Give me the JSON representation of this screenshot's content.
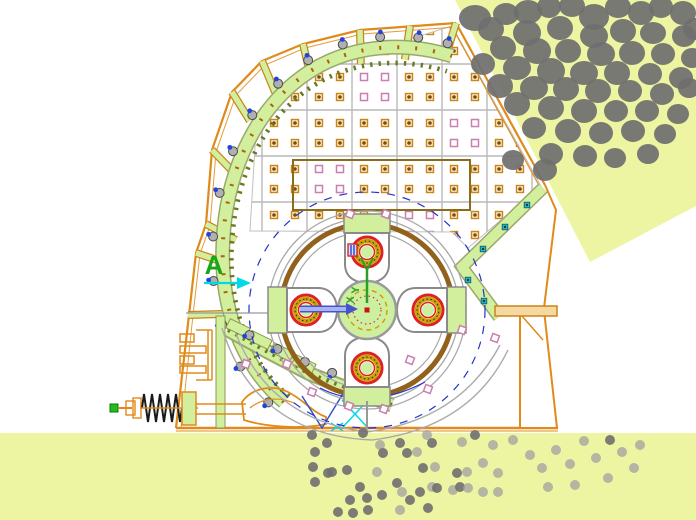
{
  "drawing": {
    "type": "cad-section-view-impact-crusher",
    "labels": {
      "section_a": "A",
      "axis_y": "Y",
      "axis_x": "X"
    }
  },
  "colors": {
    "ground": "#eef5a2",
    "rock": "#6f6f6f",
    "rock_light": "#a0a0a0",
    "casing_orange": "#e08a1a",
    "liner_fill": "#d2ef9e",
    "liner_edge": "#9aa86a",
    "teeth_olive": "#6b7a1e",
    "panel_line": "#b9b9b9",
    "bolt_pink": "#cc7fae",
    "bolt_orange": "#cc8418",
    "bolt_dot": "#7a4a10",
    "rotor_brown": "#92621c",
    "circle_gray": "#a8a8a8",
    "dashed_blue": "#2233cc",
    "ring_red": "#dd2222",
    "ring_gold": "#c8a300",
    "hub_fill": "#cdf0a0",
    "hub_dash": "#e09a00",
    "ucs_green": "#2aa02a",
    "label_green": "#17a617",
    "arrow_blue": "#4455cc",
    "arrow_blue_light": "#aab2f2",
    "cyan": "#00d9e8",
    "chute_bolt": "#2bb8c8",
    "spring_black": "#1a1a1a",
    "tip_green": "#22bb22",
    "olive_frame": "#8a6d1b"
  },
  "hub": {
    "x": 367,
    "y": 310
  },
  "hammers": [
    {
      "x": 367,
      "y": 252,
      "rot": 0
    },
    {
      "x": 428,
      "y": 310,
      "rot": 90
    },
    {
      "x": 367,
      "y": 368,
      "rot": 180
    },
    {
      "x": 306,
      "y": 310,
      "rot": 270
    }
  ],
  "liner_bolt_fractions": [
    0.02,
    0.1,
    0.18,
    0.26,
    0.34,
    0.42,
    0.5,
    0.575,
    0.65,
    0.72,
    0.79,
    0.86,
    0.93,
    0.985
  ],
  "lower_band_bolt_fractions": [
    0.08,
    0.26,
    0.44,
    0.62,
    0.8,
    0.94
  ],
  "chute_bolts": [
    [
      527,
      205
    ],
    [
      505,
      227
    ],
    [
      483,
      249
    ],
    [
      468,
      280
    ],
    [
      484,
      301
    ]
  ],
  "pink_squares": [
    [
      350,
      214
    ],
    [
      386,
      214
    ],
    [
      246,
      364
    ],
    [
      287,
      364
    ],
    [
      312,
      392
    ],
    [
      349,
      406
    ],
    [
      384,
      409
    ],
    [
      428,
      389
    ],
    [
      410,
      360
    ],
    [
      462,
      330
    ],
    [
      495,
      338
    ]
  ],
  "panel_grid": {
    "cols": [
      262,
      307,
      352,
      397,
      442,
      487,
      532
    ],
    "rows": [
      64,
      110,
      156,
      202,
      248
    ]
  },
  "rocks": [
    [
      475,
      18,
      16,
      13
    ],
    [
      506,
      14,
      13,
      11
    ],
    [
      528,
      12,
      14,
      12
    ],
    [
      549,
      7,
      12,
      11
    ],
    [
      572,
      6,
      13,
      11
    ],
    [
      594,
      17,
      15,
      13
    ],
    [
      618,
      7,
      13,
      11
    ],
    [
      641,
      13,
      13,
      12
    ],
    [
      661,
      7,
      12,
      11
    ],
    [
      683,
      13,
      13,
      12
    ],
    [
      695,
      29,
      12,
      11
    ],
    [
      491,
      29,
      13,
      12
    ],
    [
      527,
      33,
      14,
      13
    ],
    [
      560,
      28,
      13,
      12
    ],
    [
      594,
      36,
      14,
      12
    ],
    [
      623,
      31,
      13,
      12
    ],
    [
      653,
      33,
      13,
      11
    ],
    [
      684,
      36,
      12,
      11
    ],
    [
      503,
      48,
      13,
      12
    ],
    [
      537,
      51,
      14,
      13
    ],
    [
      568,
      51,
      13,
      12
    ],
    [
      601,
      54,
      14,
      12
    ],
    [
      632,
      53,
      13,
      12
    ],
    [
      663,
      54,
      12,
      11
    ],
    [
      692,
      58,
      11,
      10
    ],
    [
      483,
      64,
      12,
      11
    ],
    [
      517,
      68,
      14,
      12
    ],
    [
      551,
      71,
      14,
      13
    ],
    [
      584,
      73,
      14,
      12
    ],
    [
      617,
      73,
      13,
      12
    ],
    [
      650,
      74,
      12,
      11
    ],
    [
      681,
      78,
      12,
      11
    ],
    [
      500,
      86,
      13,
      12
    ],
    [
      534,
      88,
      14,
      12
    ],
    [
      566,
      89,
      13,
      12
    ],
    [
      598,
      91,
      13,
      12
    ],
    [
      630,
      91,
      12,
      11
    ],
    [
      662,
      94,
      12,
      11
    ],
    [
      689,
      88,
      11,
      10
    ],
    [
      517,
      104,
      13,
      12
    ],
    [
      551,
      108,
      13,
      12
    ],
    [
      584,
      111,
      13,
      12
    ],
    [
      616,
      111,
      12,
      11
    ],
    [
      647,
      111,
      12,
      11
    ],
    [
      678,
      114,
      11,
      10
    ],
    [
      534,
      128,
      12,
      11
    ],
    [
      568,
      131,
      13,
      12
    ],
    [
      601,
      133,
      12,
      11
    ],
    [
      633,
      131,
      12,
      11
    ],
    [
      665,
      134,
      11,
      10
    ],
    [
      551,
      154,
      12,
      11
    ],
    [
      585,
      156,
      12,
      11
    ],
    [
      615,
      158,
      11,
      10
    ],
    [
      648,
      154,
      11,
      10
    ],
    [
      545,
      170,
      12,
      11
    ],
    [
      513,
      160,
      11,
      10
    ]
  ],
  "discharge_dots": [
    [
      312,
      435,
      0
    ],
    [
      327,
      443,
      0
    ],
    [
      363,
      433,
      0
    ],
    [
      380,
      445,
      1
    ],
    [
      400,
      443,
      0
    ],
    [
      427,
      435,
      1
    ],
    [
      432,
      443,
      0
    ],
    [
      462,
      442,
      1
    ],
    [
      475,
      435,
      0
    ],
    [
      493,
      445,
      1
    ],
    [
      513,
      440,
      1
    ],
    [
      315,
      452,
      0
    ],
    [
      313,
      467,
      0
    ],
    [
      332,
      472,
      0
    ],
    [
      347,
      470,
      0
    ],
    [
      377,
      472,
      1
    ],
    [
      383,
      453,
      0
    ],
    [
      407,
      453,
      0
    ],
    [
      417,
      452,
      1
    ],
    [
      423,
      468,
      0
    ],
    [
      435,
      467,
      1
    ],
    [
      457,
      473,
      0
    ],
    [
      467,
      472,
      1
    ],
    [
      483,
      463,
      1
    ],
    [
      498,
      473,
      1
    ],
    [
      315,
      482,
      0
    ],
    [
      328,
      473,
      0
    ],
    [
      350,
      500,
      0
    ],
    [
      360,
      487,
      0
    ],
    [
      367,
      498,
      0
    ],
    [
      382,
      495,
      0
    ],
    [
      397,
      483,
      0
    ],
    [
      402,
      492,
      1
    ],
    [
      410,
      500,
      0
    ],
    [
      420,
      492,
      0
    ],
    [
      432,
      487,
      1
    ],
    [
      437,
      488,
      0
    ],
    [
      453,
      490,
      1
    ],
    [
      460,
      487,
      0
    ],
    [
      468,
      488,
      1
    ],
    [
      483,
      492,
      1
    ],
    [
      498,
      492,
      1
    ],
    [
      338,
      512,
      0
    ],
    [
      353,
      513,
      0
    ],
    [
      368,
      510,
      0
    ],
    [
      400,
      510,
      1
    ],
    [
      428,
      508,
      0
    ],
    [
      530,
      455,
      1
    ],
    [
      542,
      468,
      1
    ],
    [
      556,
      450,
      1
    ],
    [
      570,
      464,
      1
    ],
    [
      584,
      441,
      1
    ],
    [
      596,
      458,
      1
    ],
    [
      608,
      478,
      1
    ],
    [
      622,
      452,
      1
    ],
    [
      634,
      468,
      1
    ],
    [
      575,
      485,
      1
    ],
    [
      548,
      487,
      1
    ],
    [
      610,
      440,
      0
    ],
    [
      640,
      445,
      1
    ]
  ]
}
